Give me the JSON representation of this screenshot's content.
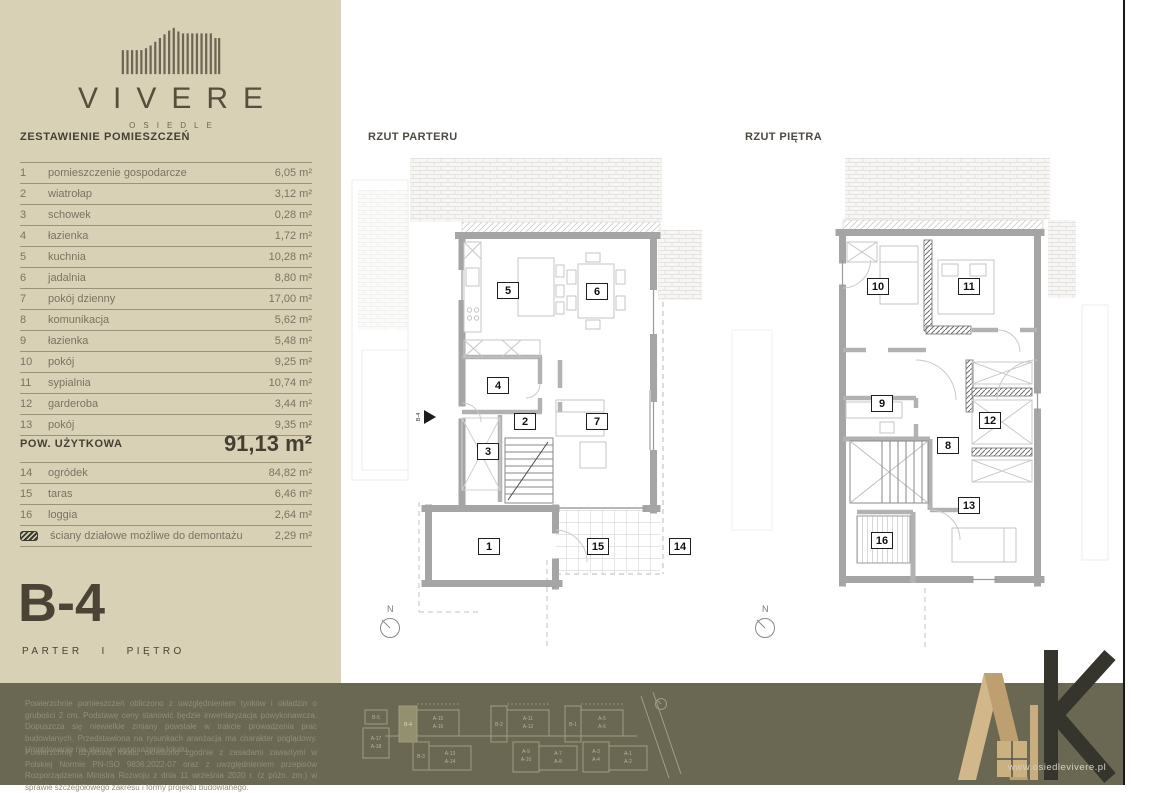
{
  "sidebar": {
    "logo": {
      "name": "VIVERE",
      "subtitle": "OSIEDLE"
    },
    "table_title": "ZESTAWIENIE POMIESZCZEŃ",
    "rooms": [
      {
        "no": "1",
        "name": "pomieszczenie gospodarcze",
        "area": "6,05 m²"
      },
      {
        "no": "2",
        "name": "wiatrołap",
        "area": "3,12 m²"
      },
      {
        "no": "3",
        "name": "schowek",
        "area": "0,28 m²"
      },
      {
        "no": "4",
        "name": "łazienka",
        "area": "1,72 m²"
      },
      {
        "no": "5",
        "name": "kuchnia",
        "area": "10,28 m²"
      },
      {
        "no": "6",
        "name": "jadalnia",
        "area": "8,80 m²"
      },
      {
        "no": "7",
        "name": "pokój dzienny",
        "area": "17,00 m²"
      },
      {
        "no": "8",
        "name": "komunikacja",
        "area": "5,62 m²"
      },
      {
        "no": "9",
        "name": "łazienka",
        "area": "5,48 m²"
      },
      {
        "no": "10",
        "name": "pokój",
        "area": "9,25 m²"
      },
      {
        "no": "11",
        "name": "sypialnia",
        "area": "10,74 m²"
      },
      {
        "no": "12",
        "name": "garderoba",
        "area": "3,44 m²"
      },
      {
        "no": "13",
        "name": "pokój",
        "area": "9,35 m²"
      }
    ],
    "total": {
      "label": "POW. UŻYTKOWA",
      "value": "91,13 m²"
    },
    "extras": [
      {
        "no": "14",
        "name": "ogródek",
        "area": "84,82 m²"
      },
      {
        "no": "15",
        "name": "taras",
        "area": "6,46 m²"
      },
      {
        "no": "16",
        "name": "loggia",
        "area": "2,64 m²"
      }
    ],
    "demountable": {
      "name": "ściany działowe możliwe do demontażu",
      "area": "2,29 m²"
    },
    "unit_code": "B-4",
    "floors_label": "PARTER   I   PIĘTRO"
  },
  "plans": {
    "ground": {
      "title": "RZUT PARTERU",
      "north_label": "N",
      "entrance_label": "B-4",
      "room_numbers": [
        "5",
        "6",
        "4",
        "2",
        "7",
        "3",
        "1",
        "15",
        "14"
      ]
    },
    "first": {
      "title": "RZUT PIĘTRA",
      "north_label": "N",
      "room_numbers": [
        "10",
        "11",
        "9",
        "12",
        "8",
        "13",
        "16"
      ]
    }
  },
  "footer": {
    "paragraph1": "Powierzchnie pomieszczeń obliczono z uwzględnieniem tynków i okładzin o grubości 2 cm. Podstawę ceny stanowić będzie inwentaryzacja powykonawcza. Dopuszcza się niewielkie zmiany powstałe w trakcie prowadzenia prac budowlanych. Przedstawiona na rysunkach aranżacja ma charakter poglądowy. Umeblowanie nie stanowi wyposażenia lokalu.",
    "paragraph2": "Powierzchnię użytkową lokalu określono zgodnie z zasadami zawartymi w Polskiej Normie PN-ISO 9836:2022-07 oraz z uwzględnieniem przepisów Rozporządzenia Ministra Rozwoju z dnia 11 września 2020 r. (z późn. zm.) w sprawie szczegółowego zakresu i formy projektu budowlanego.",
    "site_plan": {
      "labels": [
        "B-4",
        "A-15",
        "A-16",
        "B-2",
        "A-11",
        "A-12",
        "B-1",
        "A-5",
        "A-6",
        "B-5",
        "A-17",
        "A-18",
        "B-3",
        "A-13",
        "A-14",
        "A-9",
        "A-10",
        "A-7",
        "A-8",
        "A-3",
        "A-4",
        "A-1",
        "A-2"
      ]
    },
    "logo_url": "www.osiedlevivere.pl"
  }
}
